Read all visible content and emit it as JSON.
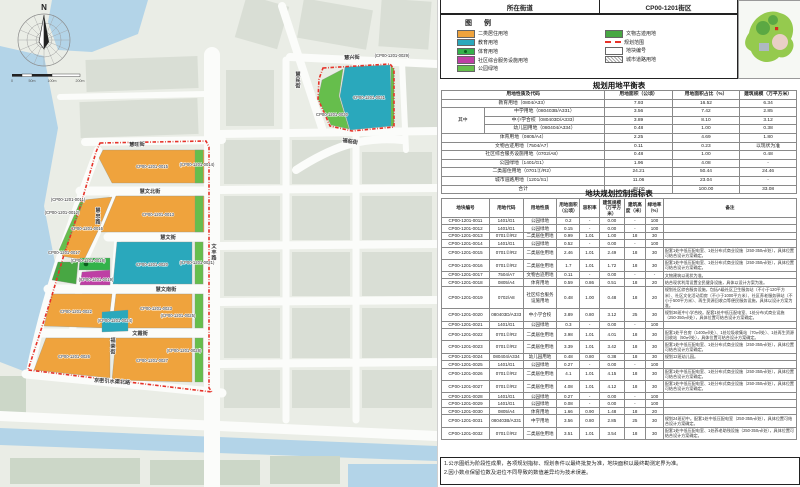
{
  "header": {
    "left": "所在街道",
    "right": "CP00-1201街区"
  },
  "legend": {
    "title": "图  例",
    "items_left": [
      {
        "label": "二类居住用地",
        "type": "solid",
        "color": "#EFA33D"
      },
      {
        "label": "教育用地",
        "type": "solid",
        "color": "#2AA8BC"
      },
      {
        "label": "体育用地",
        "type": "solid-dot",
        "color": "#33B24A"
      },
      {
        "label": "社区综合服务设施用地",
        "type": "solid",
        "color": "#BE3FA4"
      },
      {
        "label": "公园绿地",
        "type": "solid",
        "color": "#66BE4C"
      }
    ],
    "items_right": [
      {
        "label": "文物古迹用地",
        "type": "solid",
        "color": "#48A743"
      },
      {
        "label": "规划范围",
        "type": "dash",
        "color": "#E6332A"
      },
      {
        "label": "地块编号",
        "type": "box",
        "color": "#FFFFFF"
      },
      {
        "label": "城市道路用地",
        "type": "hatch",
        "color": "#AAAAAA"
      }
    ]
  },
  "balance_table": {
    "title": "规划用地平衡表",
    "headers": [
      "用地性质及代码",
      "用地面积（公顷）",
      "用地面积占比（%）",
      "建筑规模（万平方米）"
    ],
    "group_label": "其中",
    "rows": [
      {
        "type": "full",
        "name": "教育用地（0804/A33）",
        "area": "7.93",
        "pct": "16.52",
        "bldg": "6.34"
      },
      {
        "type": "sub_first",
        "name": "中学用地（080403B/A331）",
        "area": "3.56",
        "pct": "7.42",
        "bldg": "2.85"
      },
      {
        "type": "sub",
        "name": "中小学合校（080403D/A333）",
        "area": "3.89",
        "pct": "8.10",
        "bldg": "3.12"
      },
      {
        "type": "sub",
        "name": "幼儿园用地（080404/A334）",
        "area": "0.48",
        "pct": "1.00",
        "bldg": "0.38"
      },
      {
        "type": "full",
        "name": "体育用地（0805/A4）",
        "area": "2.25",
        "pct": "4.69",
        "bldg": "1.80"
      },
      {
        "type": "full",
        "name": "文物古迹用地（7504/A7）",
        "area": "0.11",
        "pct": "0.23",
        "bldg": "以现状为准"
      },
      {
        "type": "full",
        "name": "社区综合服务设施用地（0702/A8）",
        "area": "0.48",
        "pct": "1.00",
        "bldg": "0.48"
      },
      {
        "type": "full",
        "name": "公园绿地（1401/G1）",
        "area": "1.96",
        "pct": "4.08",
        "bldg": "-"
      },
      {
        "type": "full",
        "name": "二类居住用地（0701②/R2）",
        "area": "24.21",
        "pct": "50.44",
        "bldg": "24.46"
      },
      {
        "type": "full",
        "name": "城市道路用地（1201/S1）",
        "area": "11.06",
        "pct": "23.04",
        "bldg": "-"
      },
      {
        "type": "full",
        "name": "合计",
        "area": "48.00",
        "pct": "100.00",
        "bldg": "33.08"
      }
    ]
  },
  "control_table": {
    "title": "地块规划控制指标表",
    "headers": [
      "地块编号",
      "用地代码",
      "用地性质",
      "用地面积（公顷）",
      "容积率",
      "建筑规模（万平方米）",
      "建筑高度（米）",
      "绿地率（%）",
      "备注"
    ],
    "rows": [
      [
        "CP00-1201-0011",
        "1401/G1",
        "公园绿地",
        "0.2",
        "-",
        "0.00",
        "-",
        "100",
        ""
      ],
      [
        "CP00-1201-0012",
        "1401/G1",
        "公园绿地",
        "0.15",
        "-",
        "0.00",
        "-",
        "100",
        ""
      ],
      [
        "CP00-1201-0013",
        "0701②/R2",
        "二类居住用地",
        "0.99",
        "1.01",
        "1.00",
        "18",
        "30",
        ""
      ],
      [
        "CP00-1201-0014",
        "1401/G1",
        "公园绿地",
        "0.52",
        "-",
        "0.00",
        "-",
        "100",
        ""
      ],
      [
        "CP00-1201-0015",
        "0701②/R2",
        "二类居住用地",
        "2.46",
        "1.01",
        "2.49",
        "18",
        "30",
        "配套1处中低压配电室、1处分布式商业设施（250-350㎡/处），具体位置可结合设计方案确定。"
      ],
      [
        "CP00-1201-0016",
        "0701②/R2",
        "二类居住用地",
        "1.7",
        "1.01",
        "1.72",
        "18",
        "30",
        "配套1处中低压配电室、1处分布式商业设施（250-350㎡/处），具体位置可结合设计方案确定。"
      ],
      [
        "CP00-1201-0017",
        "7504/A7",
        "文物古迹用地",
        "0.11",
        "-",
        "0.00",
        "-",
        "-",
        "文物建筑以现状为准。"
      ],
      [
        "CP00-1201-0018",
        "0805/A4",
        "体育用地",
        "0.59",
        "0.86",
        "0.51",
        "18",
        "20",
        "结合现状利用设置全民健身设施，具体以设计方案为准。"
      ],
      [
        "CP00-1201-0019",
        "0702/A8",
        "社区综合服务设施用地",
        "0.48",
        "1.00",
        "0.48",
        "18",
        "20",
        "规划社区综合服务设施，包括A级社区卫生服务站（不小于120平方米）、社区文化活动用房（不小于1000平方米）、社区养老服务驿站（不小于500平方米）、再生资源回收点等便民服务设施，具体以设计方案为准。"
      ],
      [
        "CP00-1201-0020",
        "080403D/A333",
        "中小学合校",
        "3.89",
        "0.80",
        "3.12",
        "25",
        "30",
        "规划36班中小学合校。配套1处中低压配电室、1处分布式商业设施（250-350㎡/处），具体位置可结合设计方案确定。"
      ],
      [
        "CP00-1201-0021",
        "1401/G1",
        "公园绿地",
        "0.3",
        "-",
        "0.00",
        "-",
        "100",
        ""
      ],
      [
        "CP00-1201-0022",
        "0701②/R2",
        "二类居住用地",
        "3.98",
        "1.01",
        "4.01",
        "18",
        "30",
        "配套1处平台房（1400㎡/处）、1处垃圾收集站（70㎡/处）、1处再生资源回收站（50㎡/处），具体位置可结合设计方案确定。"
      ],
      [
        "CP00-1201-0023",
        "0701②/R2",
        "二类居住用地",
        "3.39",
        "1.01",
        "3.42",
        "18",
        "30",
        "配套1处中低压配电室、1处分布式商业设施（250-350㎡/处），具体位置可结合设计方案确定。"
      ],
      [
        "CP00-1201-0024",
        "080404/A334",
        "幼儿园用地",
        "0.48",
        "0.80",
        "0.38",
        "18",
        "30",
        "规划12班幼儿园。"
      ],
      [
        "CP00-1201-0025",
        "1401/G1",
        "公园绿地",
        "0.27",
        "-",
        "0.00",
        "-",
        "100",
        ""
      ],
      [
        "CP00-1201-0026",
        "0701②/R2",
        "二类居住用地",
        "4.1",
        "1.01",
        "4.15",
        "18",
        "30",
        "配套1处中低压配电室、1处分布式商业设施（250-350㎡/处），具体位置可结合设计方案确定。"
      ],
      [
        "CP00-1201-0027",
        "0701②/R2",
        "二类居住用地",
        "4.08",
        "1.01",
        "4.12",
        "18",
        "30",
        "配套1处中低压配电室、1处分布式商业设施（250-350㎡/处），具体位置可结合设计方案确定。"
      ],
      [
        "CP00-1201-0028",
        "1401/G1",
        "公园绿地",
        "0.27",
        "-",
        "0.00",
        "-",
        "100",
        ""
      ],
      [
        "CP00-1201-0029",
        "1401/G1",
        "公园绿地",
        "0.08",
        "-",
        "0.00",
        "-",
        "100",
        ""
      ],
      [
        "CP00-1201-0030",
        "0805/A4",
        "体育用地",
        "1.66",
        "0.90",
        "1.48",
        "18",
        "20",
        ""
      ],
      [
        "CP00-1201-0031",
        "080403B/A331",
        "中学用地",
        "3.56",
        "0.80",
        "2.85",
        "25",
        "30",
        "规划24班初中。配套1处中低压配电室（250-350㎡/处），具体位置可结合设计方案确定。"
      ],
      [
        "CP00-1201-0032",
        "0701②/R2",
        "二类居住用地",
        "3.51",
        "1.01",
        "3.54",
        "18",
        "30",
        "配套1处中低压配电室、1处养老助残设施（250-350㎡/处），具体位置可结合设计方案确定。"
      ]
    ]
  },
  "notes": [
    "1.公示图纸为阶段性成果，各项规划指标、规划条件以最终批复为准，地块面积以最终勘测定界为准。",
    "2.因小数点保留位数及进位不同导致的数值差异均为技术误差。"
  ],
  "map": {
    "compass": "N",
    "scale_labels": [
      "0",
      "50m",
      "100m",
      "200m"
    ],
    "colors": {
      "residential": "#EFA33D",
      "education": "#2AA8BC",
      "sports": "#33B24A",
      "community": "#BE3FA4",
      "park": "#66BE4C",
      "heritage": "#48A743",
      "boundary": "#E6332A",
      "water": "#B3D4E8"
    },
    "street_labels": [
      {
        "text": "慧旺街",
        "x": 137,
        "y": 146,
        "r": -2
      },
      {
        "text": "慧文北街",
        "x": 150,
        "y": 193,
        "r": 0
      },
      {
        "text": "慧文街",
        "x": 168,
        "y": 239,
        "r": 0
      },
      {
        "text": "慧文南街",
        "x": 166,
        "y": 291,
        "r": 0
      },
      {
        "text": "文霞街",
        "x": 140,
        "y": 335,
        "r": 0
      },
      {
        "text": "京密引水渠北路",
        "x": 112,
        "y": 383,
        "r": 4
      },
      {
        "text": "文丰路",
        "x": 214,
        "y": 248,
        "v": true
      },
      {
        "text": "慧忠路",
        "x": 98,
        "y": 212,
        "v": true
      },
      {
        "text": "福荣街",
        "x": 113,
        "y": 342,
        "v": true
      },
      {
        "text": "慧兴街",
        "x": 352,
        "y": 59,
        "r": -3
      },
      {
        "text": "慧民街",
        "x": 298,
        "y": 76,
        "v": true
      },
      {
        "text": "福临街",
        "x": 350,
        "y": 143,
        "r": 8
      }
    ],
    "block_labels": [
      {
        "text": "CP00-1201-0015",
        "x": 152,
        "y": 168
      },
      {
        "text": "(CP00-1201-0011)",
        "x": 68,
        "y": 201
      },
      {
        "text": "(CP00-1201-0012)",
        "x": 62,
        "y": 214
      },
      {
        "text": "CP00-1201-0013",
        "x": 158,
        "y": 216
      },
      {
        "text": "(CP00-1201-0014)",
        "x": 197,
        "y": 166
      },
      {
        "text": "CP00-1201-0016",
        "x": 87,
        "y": 230
      },
      {
        "text": "CP00-1201-0017",
        "x": 64,
        "y": 254
      },
      {
        "text": "(CP00-1201-0018)",
        "x": 88,
        "y": 262
      },
      {
        "text": "(CP00-1201-0019)",
        "x": 96,
        "y": 281
      },
      {
        "text": "CP00-1201-0020",
        "x": 152,
        "y": 266
      },
      {
        "text": "(CP00-1201-0021)",
        "x": 197,
        "y": 264
      },
      {
        "text": "CP00-1201-0022",
        "x": 76,
        "y": 313
      },
      {
        "text": "CP00-1201-0023",
        "x": 156,
        "y": 310
      },
      {
        "text": "(CP00-1201-0024)",
        "x": 115,
        "y": 322
      },
      {
        "text": "(CP00-1201-0025)",
        "x": 178,
        "y": 317
      },
      {
        "text": "CP00-1201-0026",
        "x": 74,
        "y": 358
      },
      {
        "text": "CP00-1201-0027",
        "x": 152,
        "y": 362
      },
      {
        "text": "(CP00-1201-0028)",
        "x": 184,
        "y": 352
      },
      {
        "text": "(CP00-1201-0029)",
        "x": 392,
        "y": 57
      },
      {
        "text": "CP00-1201-0030",
        "x": 332,
        "y": 116
      },
      {
        "text": "CP00-1201-0031",
        "x": 369,
        "y": 99
      }
    ]
  }
}
